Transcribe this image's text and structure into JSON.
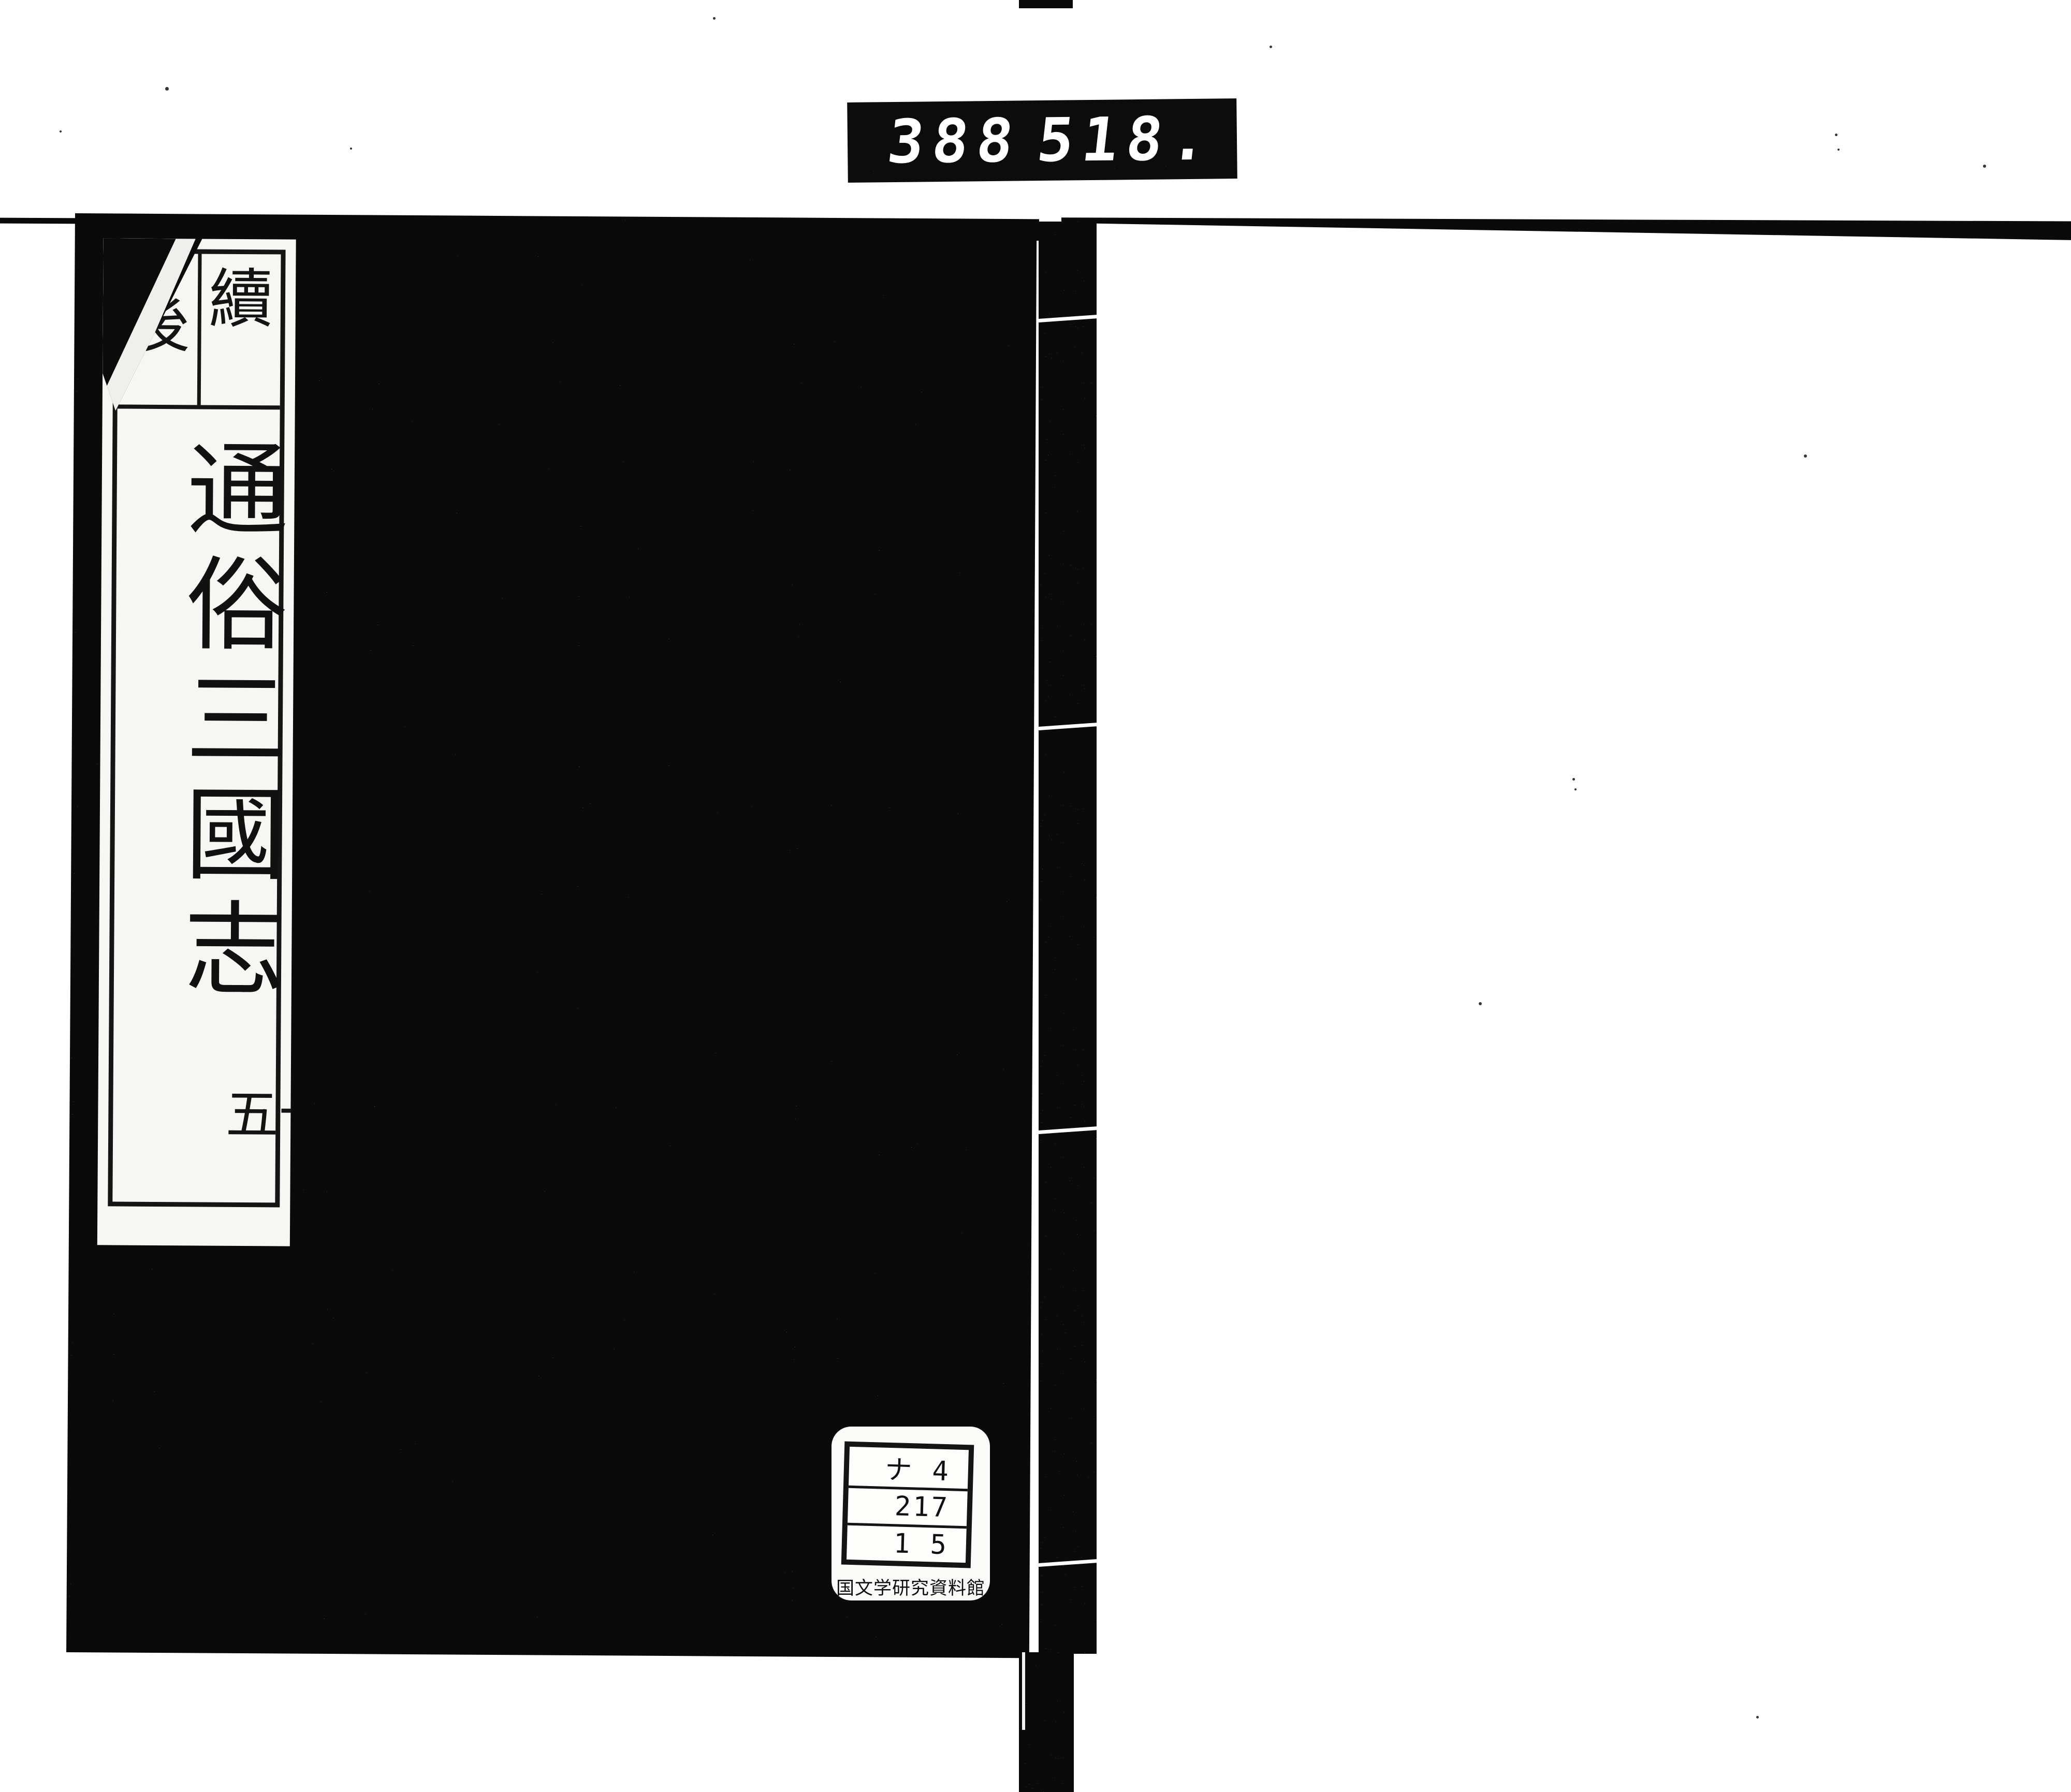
{
  "counter": {
    "digits_left": "388",
    "digits_right": "518."
  },
  "spine_label": {
    "header_right": "續",
    "header_left": "後",
    "title": "通俗三國志",
    "volume": "十五"
  },
  "call_number_label": {
    "rows": [
      "ナ 4",
      "217",
      "1 5"
    ],
    "institution": "国文学研究資料館"
  },
  "colors": {
    "ink": "#0a0a0a",
    "paper": "#ffffff",
    "label_paper": "#f6f6f3"
  }
}
